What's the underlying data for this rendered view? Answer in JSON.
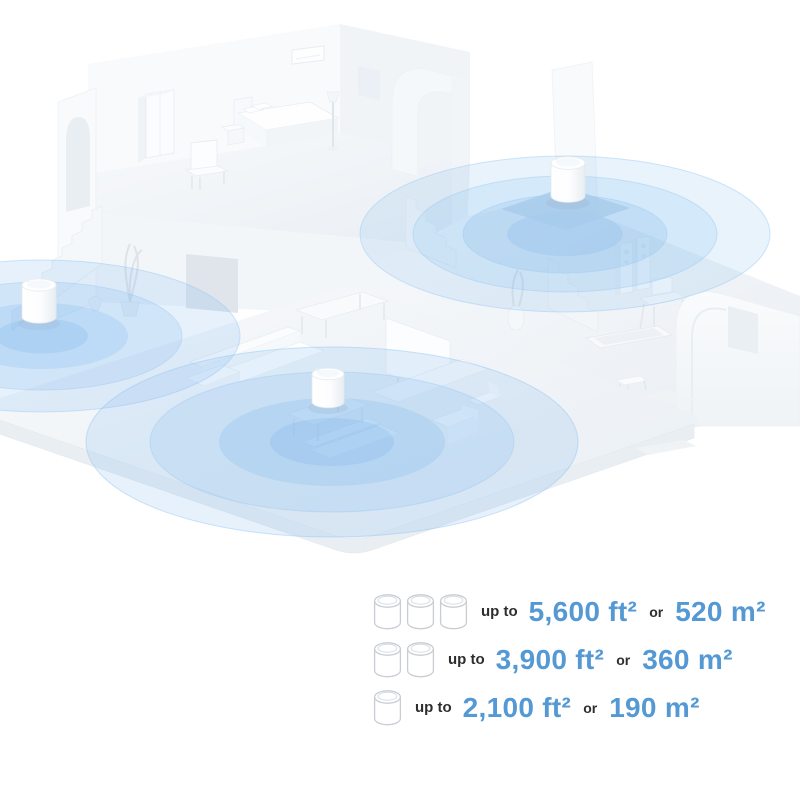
{
  "palette": {
    "accent_blue": "#5599D4",
    "label_dark": "#2E2E2E",
    "coverage_blue": "#69A9E4",
    "icon_outline_gray": "#C8CED4"
  },
  "illustration": {
    "label": "isometric-home-mesh-wifi-coverage",
    "router_units_shown": 3,
    "coverage_circle_sets": 3
  },
  "specs": {
    "rows": [
      {
        "units_count": "3",
        "prefix": "up to",
        "area_imperial": "5,600 ft²",
        "conjunction": "or",
        "area_metric": "520 m²"
      },
      {
        "units_count": "2",
        "prefix": "up to",
        "area_imperial": "3,900 ft²",
        "conjunction": "or",
        "area_metric": "360 m²"
      },
      {
        "units_count": "1",
        "prefix": "up to",
        "area_imperial": "2,100 ft²",
        "conjunction": "or",
        "area_metric": "190 m²"
      }
    ]
  }
}
